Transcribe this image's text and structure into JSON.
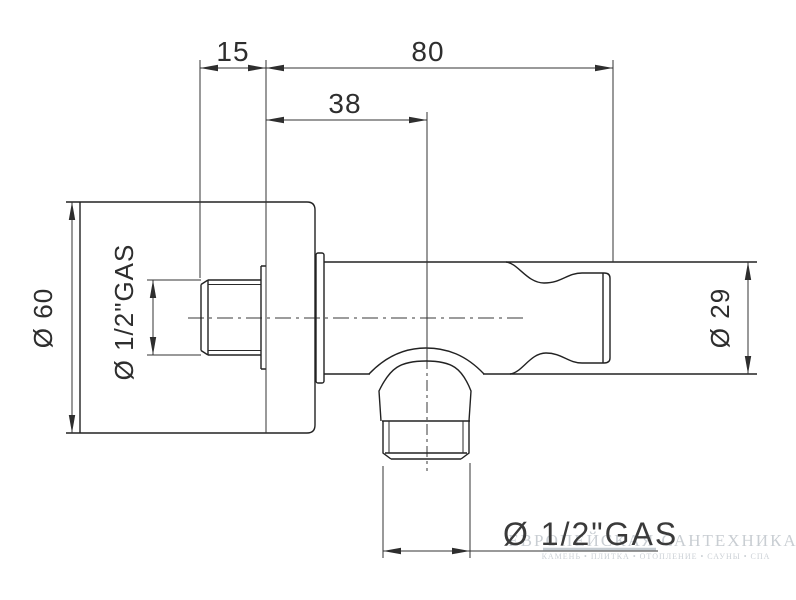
{
  "drawing": {
    "title": "Shower outlet elbow technical drawing",
    "top_dims": {
      "inlet_protrusion": "15",
      "overall_length": "80",
      "outlet_offset": "38"
    },
    "left_dims": {
      "plate_diameter": "Ø 60",
      "inlet_thread": "Ø 1/2\"GAS"
    },
    "right_dims": {
      "body_diameter": "Ø 29"
    },
    "bottom_dims": {
      "outlet_thread": "Ø 1/2\"GAS"
    },
    "watermark": {
      "title": "ЕВРОПЕЙСКАЯ САНТЕХНИКА",
      "tagline": "КАМЕНЬ • ПЛИТКА • ОТОПЛЕНИЕ • САУНЫ • СПА"
    },
    "colors": {
      "background": "#ffffff",
      "object_line": "#222222",
      "dimension_line": "#333333",
      "watermark": "#c9ced3"
    }
  }
}
